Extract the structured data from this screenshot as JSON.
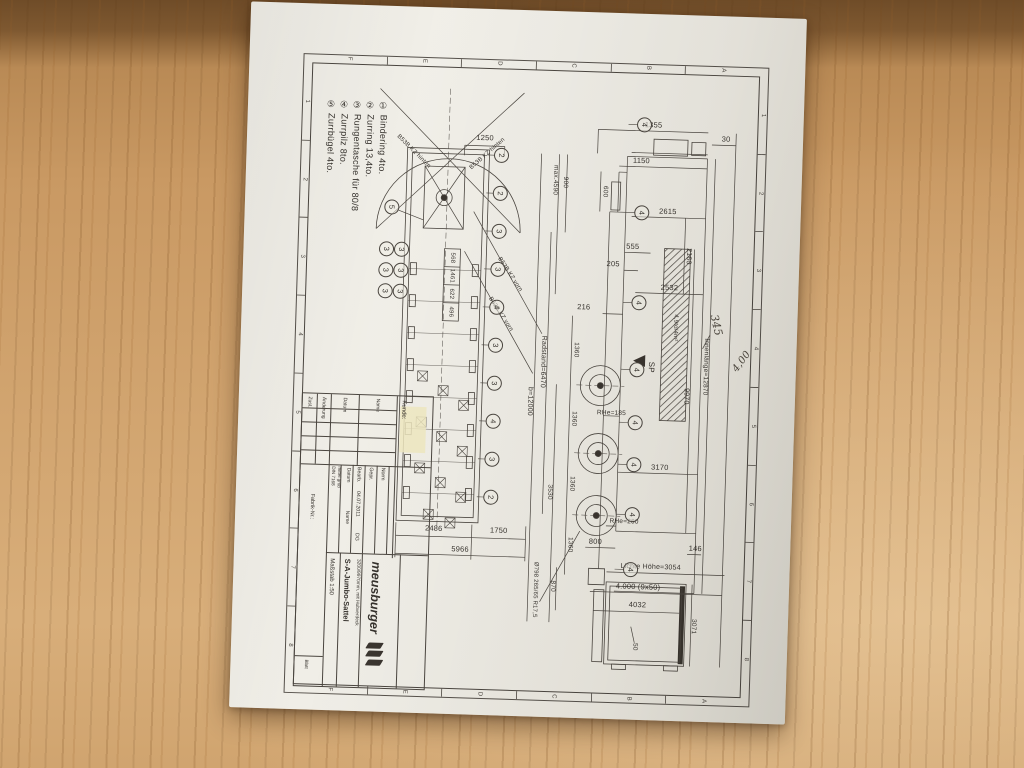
{
  "scene": {
    "paper_color": "#efede6",
    "ink_color": "#4a453f",
    "wood_color": "#c79a66",
    "description": "Photo of a technical drawing of a Meusburger jumbo semi-trailer lying on a wooden desk"
  },
  "legend": {
    "items": [
      "① Bindering 4to.",
      "② Zurring 13,4to.",
      "③ Rungentasche für 80/8",
      "④ Zurrpilz 8to.",
      "⑤ Zurrbügel 4to."
    ]
  },
  "title_block": {
    "kunde_label": "Kunde:",
    "brand": "meusburger",
    "product": "S-A-Jumbo-Sattel",
    "subtitle": "3200/9970mm, mit Hubverdeck",
    "scale": "Maßstab 1:50",
    "din": "DIN 7168",
    "din2": "mittel grob",
    "col_datum": "Datum",
    "col_name": "Name",
    "bearb": "Bearb.",
    "bearb_date": "04.07.2011",
    "bearb_name": "DG",
    "gepr": "Gepr.",
    "norm": "Norm",
    "fabrik": "Fabrik-Nr.:",
    "blatt": "Blatt",
    "rev_headers": [
      "Zust.",
      "Änderung",
      "Datum",
      "Name"
    ]
  },
  "frame_refs": {
    "numbers": [
      "1",
      "2",
      "3",
      "4",
      "5",
      "6",
      "7",
      "8"
    ],
    "letters": [
      "F",
      "E",
      "D",
      "C",
      "B",
      "A"
    ]
  },
  "labels": [
    {
      "t": "1250",
      "x": 183,
      "y": 78,
      "c": "h"
    },
    {
      "t": "2486",
      "x": 144,
      "y": 470,
      "c": "h"
    },
    {
      "t": "1750",
      "x": 209,
      "y": 470,
      "c": "h"
    },
    {
      "t": "5966",
      "x": 171,
      "y": 490,
      "c": "h"
    },
    {
      "t": "B53B KZ hinten",
      "x": 112,
      "y": 94,
      "c": "d2",
      "s": 6
    },
    {
      "t": "B53B KZ hinten",
      "x": 186,
      "y": 94,
      "c": "d1",
      "s": 6
    },
    {
      "t": "B53B KZ vorn",
      "x": 212,
      "y": 214,
      "c": "d3",
      "s": 6
    },
    {
      "t": "B53B KZ vorn",
      "x": 204,
      "y": 254,
      "c": "d3",
      "s": 6
    },
    {
      "t": "568",
      "x": 154,
      "y": 199,
      "c": "v",
      "s": 6
    },
    {
      "t": "1461",
      "x": 154,
      "y": 217,
      "c": "v",
      "s": 6
    },
    {
      "t": "622",
      "x": 154,
      "y": 235,
      "c": "v",
      "s": 6
    },
    {
      "t": "496",
      "x": 154,
      "y": 253,
      "c": "v",
      "s": 6
    },
    {
      "t": "1355",
      "x": 351,
      "y": 60,
      "c": "h"
    },
    {
      "t": "30",
      "x": 424,
      "y": 72,
      "c": "h"
    },
    {
      "t": "1150",
      "x": 340,
      "y": 96,
      "c": "h"
    },
    {
      "t": "2615",
      "x": 368,
      "y": 146,
      "c": "h"
    },
    {
      "t": "555",
      "x": 334,
      "y": 182,
      "c": "h"
    },
    {
      "t": "205",
      "x": 315,
      "y": 200,
      "c": "h"
    },
    {
      "t": "2532",
      "x": 372,
      "y": 222,
      "c": "h"
    },
    {
      "t": "2160",
      "x": 390,
      "y": 190,
      "c": "v",
      "s": 7
    },
    {
      "t": "600",
      "x": 304,
      "y": 128,
      "c": "v",
      "s": 6.5
    },
    {
      "t": "216",
      "x": 287,
      "y": 244,
      "c": "h"
    },
    {
      "t": "max.4590",
      "x": 254,
      "y": 118,
      "c": "v",
      "s": 6.5
    },
    {
      "t": "900",
      "x": 264,
      "y": 120,
      "c": "v",
      "s": 6.5
    },
    {
      "t": "Radstand=6470",
      "x": 248,
      "y": 300,
      "c": "v",
      "s": 7
    },
    {
      "t": "b=12000",
      "x": 236,
      "y": 340,
      "c": "v",
      "s": 7
    },
    {
      "t": "1360",
      "x": 280,
      "y": 287,
      "c": "v",
      "s": 6.5
    },
    {
      "t": "1360",
      "x": 280,
      "y": 356,
      "c": "v",
      "s": 6.5
    },
    {
      "t": "1360",
      "x": 280,
      "y": 421,
      "c": "v",
      "s": 6.5
    },
    {
      "t": "1360",
      "x": 280,
      "y": 482,
      "c": "v",
      "s": 6.5
    },
    {
      "t": "870",
      "x": 264,
      "y": 524,
      "c": "v",
      "s": 6.5
    },
    {
      "t": "3530",
      "x": 258,
      "y": 430,
      "c": "v",
      "s": 6.5
    },
    {
      "t": "Ø798 265/65 R17,5",
      "x": 247,
      "y": 528,
      "c": "v",
      "s": 6
    },
    {
      "t": "RHe=185",
      "x": 318,
      "y": 350,
      "c": "h",
      "s": 6.5
    },
    {
      "t": "3170",
      "x": 368,
      "y": 402,
      "c": "h"
    },
    {
      "t": "RHe=260",
      "x": 334,
      "y": 458,
      "c": "h",
      "s": 6.5
    },
    {
      "t": "800",
      "x": 306,
      "y": 478,
      "c": "h"
    },
    {
      "t": "146",
      "x": 406,
      "y": 482,
      "c": "h"
    },
    {
      "t": "Lichte Höhe=3054",
      "x": 362,
      "y": 502,
      "c": "h",
      "s": 7
    },
    {
      "t": "4.000 (9x50)",
      "x": 350,
      "y": 522,
      "c": "h"
    },
    {
      "t": "9970",
      "x": 392,
      "y": 330,
      "c": "v",
      "s": 7
    },
    {
      "t": "Innenlänge=12870",
      "x": 410,
      "y": 300,
      "c": "v",
      "s": 6.5
    },
    {
      "t": "4,9to/4m²",
      "x": 379,
      "y": 262,
      "c": "v",
      "s": 6
    },
    {
      "t": "SP",
      "x": 356,
      "y": 302,
      "c": "v",
      "s": 8
    },
    {
      "t": "345",
      "x": 420,
      "y": 258,
      "c": "hw"
    },
    {
      "t": "4,00",
      "x": 447,
      "y": 294,
      "c": "hw2"
    },
    {
      "t": "4032",
      "x": 350,
      "y": 540,
      "c": "h"
    },
    {
      "t": "3071",
      "x": 406,
      "y": 560,
      "c": "v",
      "s": 6.5
    },
    {
      "t": "50",
      "x": 348,
      "y": 582,
      "c": "v",
      "s": 6.5
    }
  ],
  "markers": [
    {
      "x": 200,
      "y": 95,
      "d": "2"
    },
    {
      "x": 200,
      "y": 133,
      "d": "2"
    },
    {
      "x": 200,
      "y": 171,
      "d": "3"
    },
    {
      "x": 200,
      "y": 209,
      "d": "3"
    },
    {
      "x": 200,
      "y": 247,
      "d": "4"
    },
    {
      "x": 200,
      "y": 285,
      "d": "3"
    },
    {
      "x": 200,
      "y": 323,
      "d": "3"
    },
    {
      "x": 200,
      "y": 361,
      "d": "4"
    },
    {
      "x": 200,
      "y": 399,
      "d": "3"
    },
    {
      "x": 200,
      "y": 437,
      "d": "2"
    },
    {
      "x": 88,
      "y": 192,
      "d": "3"
    },
    {
      "x": 103,
      "y": 192,
      "d": "3"
    },
    {
      "x": 88,
      "y": 213,
      "d": "3"
    },
    {
      "x": 103,
      "y": 213,
      "d": "3"
    },
    {
      "x": 88,
      "y": 234,
      "d": "3"
    },
    {
      "x": 103,
      "y": 234,
      "d": "3"
    },
    {
      "x": 92,
      "y": 150,
      "d": "5"
    },
    {
      "x": 342,
      "y": 60,
      "d": "4"
    },
    {
      "x": 342,
      "y": 148,
      "d": "4"
    },
    {
      "x": 342,
      "y": 238,
      "d": "4"
    },
    {
      "x": 342,
      "y": 305,
      "d": "4"
    },
    {
      "x": 342,
      "y": 358,
      "d": "4"
    },
    {
      "x": 342,
      "y": 400,
      "d": "4"
    },
    {
      "x": 342,
      "y": 450,
      "d": "4"
    },
    {
      "x": 342,
      "y": 505,
      "d": "4"
    }
  ]
}
